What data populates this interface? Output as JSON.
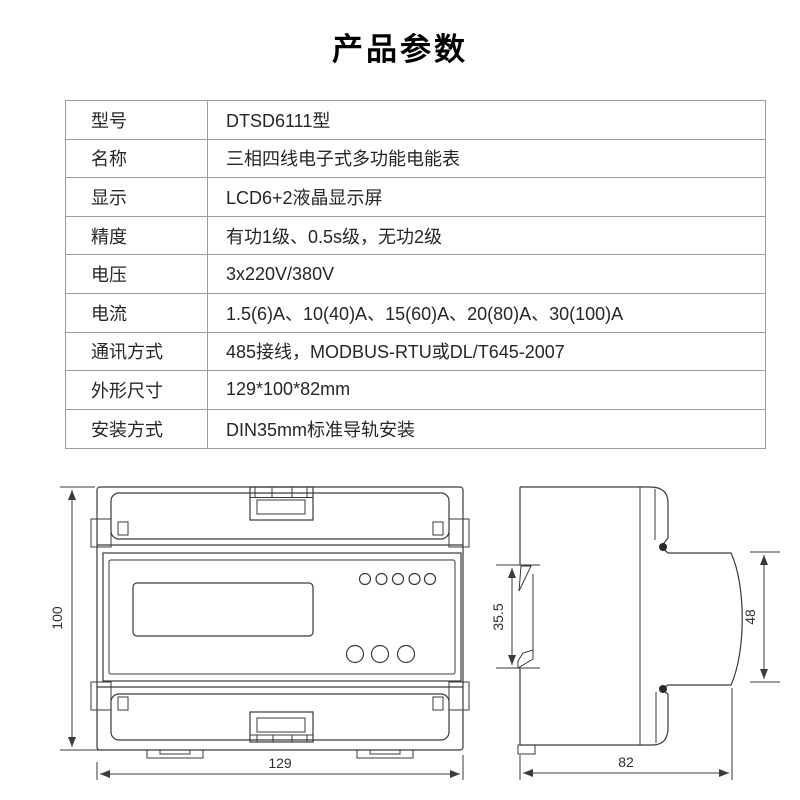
{
  "title": "产品参数",
  "spec_table": {
    "rows": [
      {
        "label": "型号",
        "value": "DTSD6111型"
      },
      {
        "label": "名称",
        "value": "三相四线电子式多功能电能表"
      },
      {
        "label": "显示",
        "value": "LCD6+2液晶显示屏"
      },
      {
        "label": "精度",
        "value": "有功1级、0.5s级，无功2级"
      },
      {
        "label": "电压",
        "value": "3x220V/380V"
      },
      {
        "label": "电流",
        "value": "1.5(6)A、10(40)A、15(60)A、20(80)A、30(100)A"
      },
      {
        "label": "通讯方式",
        "value": "485接线，MODBUS-RTU或DL/T645-2007"
      },
      {
        "label": "外形尺寸",
        "value": "129*100*82mm"
      },
      {
        "label": "安装方式",
        "value": "DIN35mm标准导轨安装"
      }
    ]
  },
  "drawings": {
    "front_view": {
      "width_mm": "129",
      "height_mm": "100"
    },
    "side_view": {
      "depth_mm": "82",
      "front_height_mm": "48",
      "rail_mm": "35.5"
    }
  },
  "colors": {
    "background": "#ffffff",
    "table_border": "#9c9c9c",
    "text": "#262626",
    "line_color": "#3a3a3a"
  }
}
